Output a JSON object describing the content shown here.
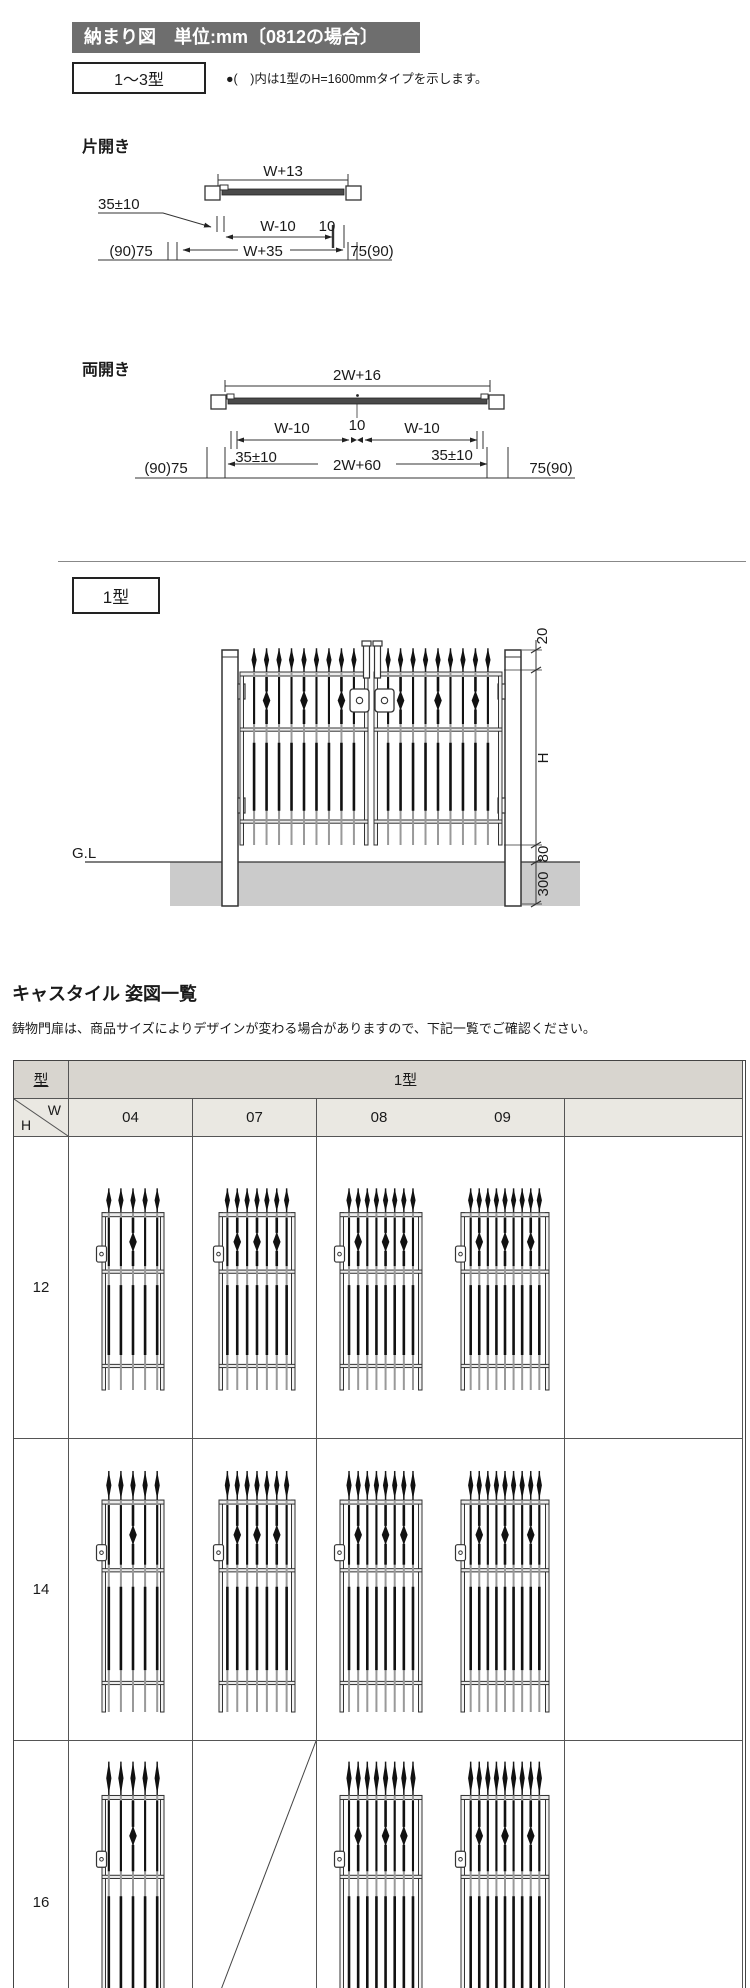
{
  "header": {
    "title": "納まり図　単位:mm〔0812の場合〕",
    "bg": "#6e6e6e",
    "text_color": "#ffffff"
  },
  "type_range": {
    "label": "1〜3型",
    "note": "●(　)内は1型のH=1600mmタイプを示します。"
  },
  "single_swing": {
    "label": "片開き",
    "dims": {
      "top_width": "W+13",
      "hinge_offset": "35±10",
      "leaf_width": "W-10",
      "gap": "10",
      "left_post": "(90)75",
      "overall_width": "W+35",
      "right_post": "75(90)"
    }
  },
  "double_swing": {
    "label": "両開き",
    "dims": {
      "top_width": "2W+16",
      "left_leaf": "W-10",
      "center_gap": "10",
      "right_leaf": "W-10",
      "left_offset": "35±10",
      "overall_width": "2W+60",
      "right_offset": "35±10",
      "left_post": "(90)75",
      "right_post": "75(90)"
    }
  },
  "type1": {
    "label": "1型",
    "dims": {
      "top_clearance": "20",
      "gate_height": "H",
      "bottom_clearance": "80",
      "embed_depth": "300",
      "ground_label": "G.L"
    }
  },
  "catalog": {
    "title": "キャスタイル 姿図一覧",
    "note": "鋳物門扉は、商品サイズによりデザインが変わる場合がありますので、下記一覧でご確認ください。",
    "table": {
      "type_header": "型",
      "series_header": "1型",
      "w_label": "W",
      "h_label": "H",
      "width_headers": [
        "04",
        "07",
        "08",
        "09",
        ""
      ],
      "rows": [
        {
          "h": "12",
          "cells": [
            {
              "w": "04",
              "gate": true
            },
            {
              "w": "07",
              "gate": true
            },
            {
              "w": "08",
              "gate": true
            },
            {
              "w": "09",
              "gate": true
            },
            {
              "w": "",
              "gate": false
            }
          ]
        },
        {
          "h": "14",
          "cells": [
            {
              "w": "04",
              "gate": true
            },
            {
              "w": "07",
              "gate": true
            },
            {
              "w": "08",
              "gate": true
            },
            {
              "w": "09",
              "gate": true
            },
            {
              "w": "",
              "gate": false
            }
          ]
        },
        {
          "h": "16",
          "cells": [
            {
              "w": "04",
              "gate": true
            },
            {
              "w": "07",
              "gate": false,
              "diagonal": true
            },
            {
              "w": "08",
              "gate": true
            },
            {
              "w": "09",
              "gate": true
            },
            {
              "w": "",
              "gate": false
            }
          ]
        }
      ]
    },
    "colors": {
      "header_bg": "#d8d5cf",
      "subheader_bg": "#eae8e2",
      "border": "#4a4a4a"
    }
  },
  "drawing_colors": {
    "ground": "#cbcbcb",
    "bar": "#4a4a4a",
    "line": "#333333"
  }
}
